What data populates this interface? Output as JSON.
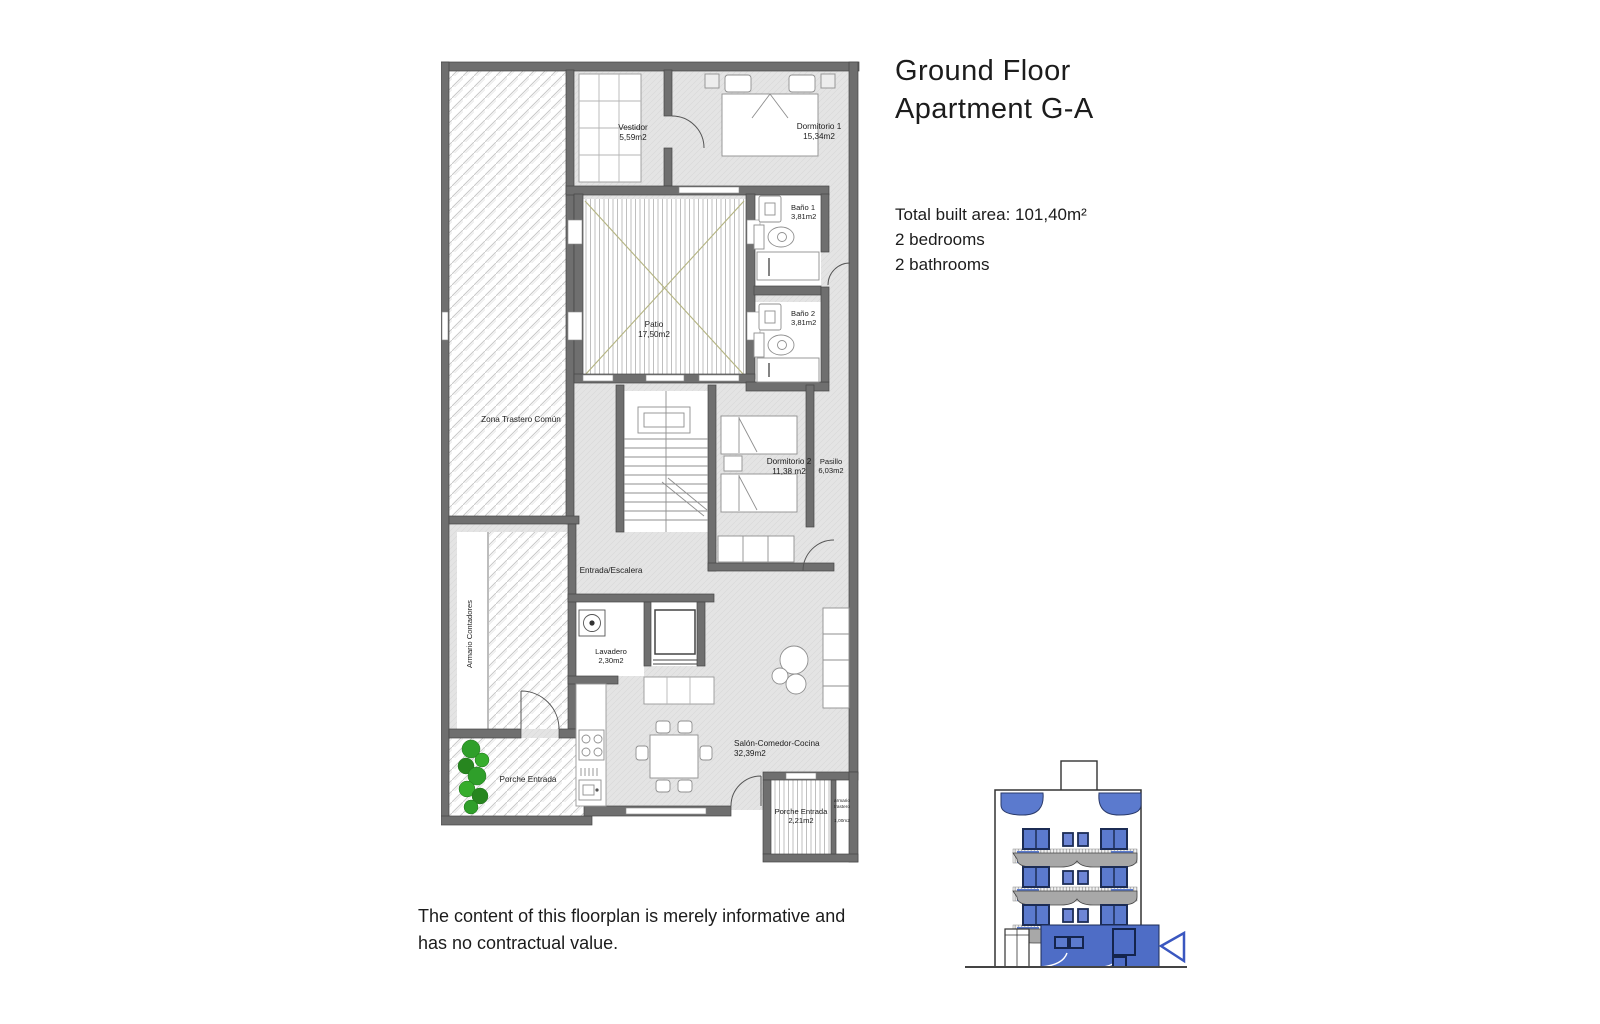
{
  "header": {
    "title_line1": "Ground Floor",
    "title_line2": "Apartment G-A",
    "total_area": "Total built area: 101,40m²",
    "bedrooms": "2 bedrooms",
    "bathrooms": "2 bathrooms"
  },
  "rooms": {
    "vestidor": {
      "name": "Vestidor",
      "area": "5,59m2"
    },
    "dormitorio1": {
      "name": "Dormitorio 1",
      "area": "15,34m2"
    },
    "bano1": {
      "name": "Baño 1",
      "area": "3,81m2"
    },
    "bano2": {
      "name": "Baño 2",
      "area": "3,81m2"
    },
    "patio": {
      "name": "Patio",
      "area": "17,50m2"
    },
    "zona_trastero": {
      "name": "Zona Trastero Común"
    },
    "dormitorio2": {
      "name": "Dormitorio 2",
      "area": "11,38 m2"
    },
    "pasillo": {
      "name": "Pasillo",
      "area": "6,03m2"
    },
    "entrada": {
      "name": "Entrada/Escalera"
    },
    "armario_contadores": {
      "name": "Armario Contadores"
    },
    "lavadero": {
      "name": "Lavadero",
      "area": "2,30m2"
    },
    "porche1": {
      "name": "Porche Entrada"
    },
    "salon": {
      "name": "Salón-Comedor-Cocina",
      "area": "32,39m2"
    },
    "porche2": {
      "name": "Porche Entrada",
      "area": "2,21m2"
    },
    "armario_trastero": {
      "line1": "armario",
      "line2": "trastero",
      "area": "1,00m2"
    }
  },
  "footer": {
    "line1": "The content of this floorplan is merely informative and",
    "line2": "has no contractual value."
  },
  "colors": {
    "wall": "#6f6f6f",
    "floor": "#e4e4e4",
    "accent_blue": "#4e6dc6",
    "window_blue": "#5b7ace",
    "patio_cross": "#b5b584",
    "plant_green": "#2f9f2a"
  }
}
